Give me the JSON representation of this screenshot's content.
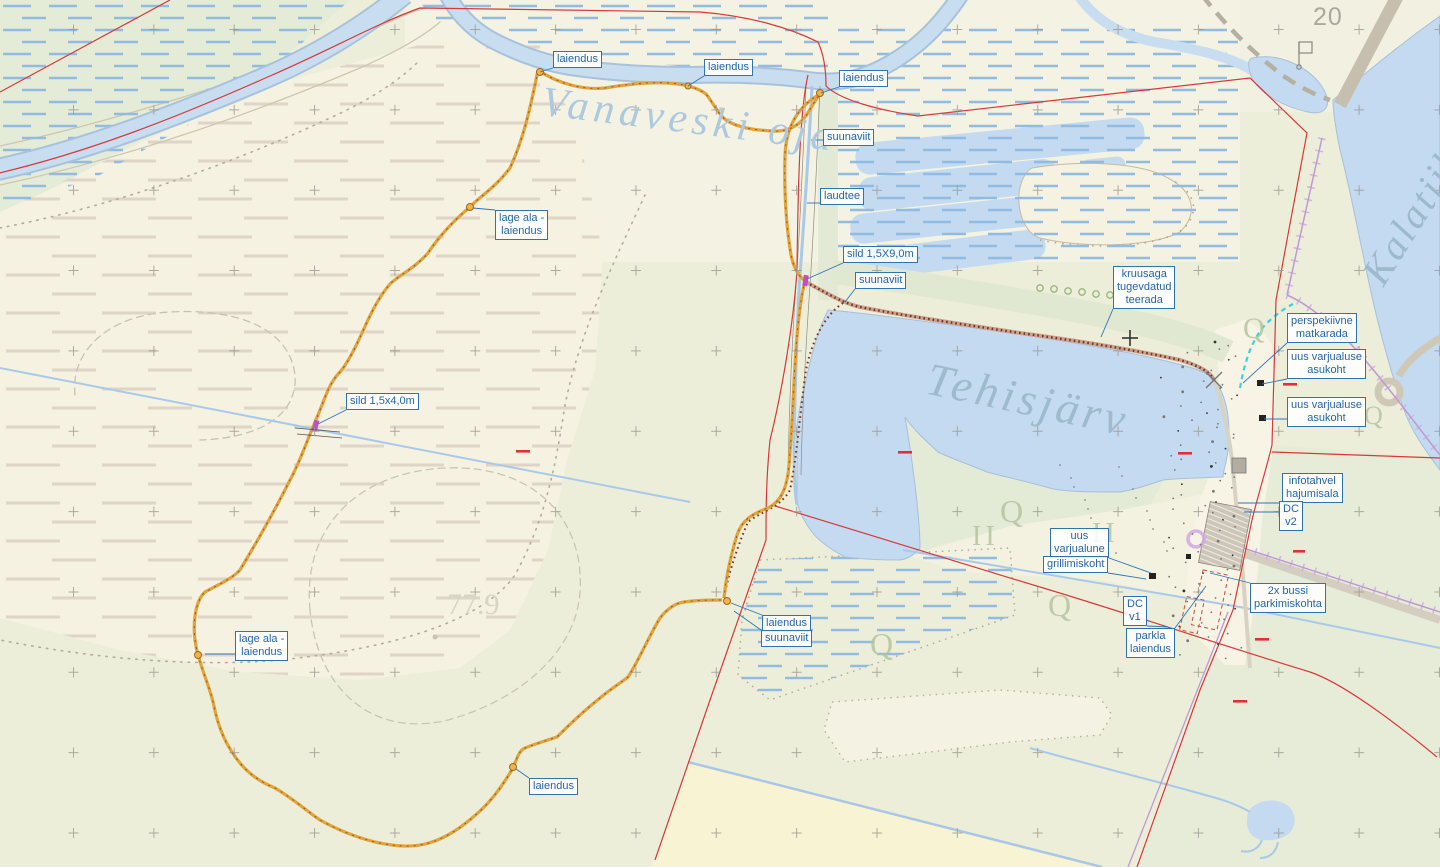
{
  "map_type": "planning-map",
  "place_names": {
    "stream": "Vanaveski oja",
    "lake": "Tehisjärv",
    "fish_pond": "Kalatiik",
    "grid_number": "20",
    "elevation_point": "77.9"
  },
  "colors": {
    "label_blue": "#2e74b5",
    "water": "#c8ddf0",
    "trail_orange": "#e2a23c",
    "gravel_path_brown": "#7a3028",
    "boundary_red": "#d83838",
    "cadastral_violet": "#bd9ad0",
    "perspective_cyan": "#3fd0dc",
    "field_yellow": "#f8f3d2",
    "bog_cream": "#f5f2e1",
    "forest_green": "#e6ecd8"
  },
  "annotations": [
    {
      "text": "laiendus",
      "x": 553,
      "y": 51,
      "tx": 540,
      "ty": 72
    },
    {
      "text": "laiendus",
      "x": 704,
      "y": 59,
      "tx": 688,
      "ty": 86
    },
    {
      "text": "laiendus",
      "x": 839,
      "y": 70,
      "tx": 821,
      "ty": 93
    },
    {
      "text": "suunaviit",
      "x": 823,
      "y": 129,
      "tx": 811,
      "ty": 140
    },
    {
      "text": "laudtee",
      "x": 820,
      "y": 188,
      "tx": 807,
      "ty": 203
    },
    {
      "text": "sild 1,5X9,0m",
      "x": 843,
      "y": 246,
      "tx": 807,
      "ty": 279
    },
    {
      "text": "suunaviit",
      "x": 855,
      "y": 272,
      "tx": 845,
      "ty": 302
    },
    {
      "text": "kruusaga\ntugevdatud\nteerada",
      "x": 1113,
      "y": 266,
      "tx": 1101,
      "ty": 337
    },
    {
      "text": "perspekiivne\nmatkarada",
      "x": 1287,
      "y": 313,
      "tx": 1243,
      "ty": 383
    },
    {
      "text": "uus varjualuse\nasukoht",
      "x": 1287,
      "y": 349,
      "tx": 1262,
      "ty": 384
    },
    {
      "text": "uus varjualuse\nasukoht",
      "x": 1287,
      "y": 397,
      "tx": 1264,
      "ty": 419
    },
    {
      "text": "infotahvel\nhajumisala",
      "x": 1282,
      "y": 473,
      "tx": 1238,
      "ty": 503
    },
    {
      "text": "DC\nv2",
      "x": 1279,
      "y": 501,
      "tx": 1244,
      "ty": 512
    },
    {
      "text": "uus\nvarjualune",
      "x": 1050,
      "y": 528,
      "tx": 1151,
      "ty": 573
    },
    {
      "text": "grillimiskoht",
      "x": 1043,
      "y": 556,
      "tx": 1146,
      "ty": 579
    },
    {
      "text": "DC\nv1",
      "x": 1123,
      "y": 596,
      "tx": 1168,
      "ty": 627
    },
    {
      "text": "2x bussi\nparkimiskohta",
      "x": 1250,
      "y": 583,
      "tx": 1210,
      "ty": 573
    },
    {
      "text": "parkla\nlaiendus",
      "x": 1126,
      "y": 628,
      "tx": 1206,
      "ty": 586
    },
    {
      "text": "lage ala -\nlaiendus",
      "x": 495,
      "y": 210,
      "tx": 473,
      "ty": 208
    },
    {
      "text": "sild 1,5x4,0m",
      "x": 346,
      "y": 393,
      "tx": 318,
      "ty": 424
    },
    {
      "text": "lage ala -\nlaiendus",
      "x": 235,
      "y": 631,
      "tx": 205,
      "ty": 654
    },
    {
      "text": "laiendus",
      "x": 762,
      "y": 615,
      "tx": 731,
      "ty": 603
    },
    {
      "text": "suunaviit",
      "x": 761,
      "y": 630,
      "tx": 734,
      "ty": 611
    },
    {
      "text": "laiendus",
      "x": 529,
      "y": 778,
      "tx": 516,
      "ty": 769
    }
  ]
}
